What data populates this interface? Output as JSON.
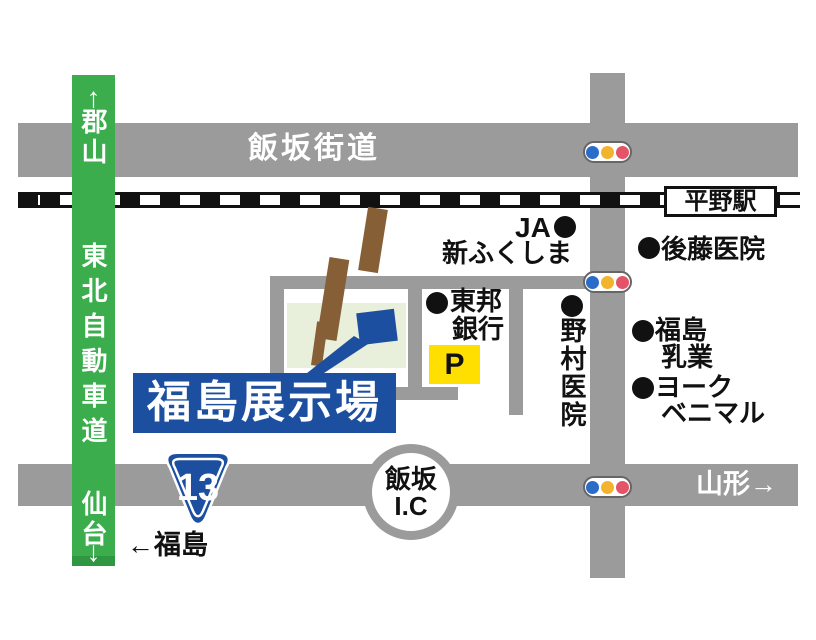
{
  "colors": {
    "road_gray": "#9b9b9b",
    "expressway_green": "#3bad4d",
    "venue_blue": "#1d4fa1",
    "parking_yellow": "#ffdf00",
    "site_light_green": "#e8efdb",
    "dirt_road_brown": "#875f37",
    "signal_blue": "#2b6cc8",
    "signal_yellow": "#f2b42c",
    "signal_red": "#e25466"
  },
  "expressway": {
    "name": "東北自動車道",
    "dest_top": "郡山",
    "dest_bottom": "仙台",
    "arrow_up": "↑",
    "arrow_down": "↓"
  },
  "roads": {
    "iizaka_kaido": "飯坂街道",
    "yamagata": "山形→",
    "fukushima": "←福島"
  },
  "route_shield": {
    "number": "13"
  },
  "interchange": {
    "line1": "飯坂",
    "line2": "I.C"
  },
  "station": {
    "name": "平野駅"
  },
  "venue": {
    "name": "福島展示場"
  },
  "parking": {
    "label": "P"
  },
  "pois": {
    "ja": {
      "line1": "JA",
      "line2": "新ふくしま"
    },
    "goto": {
      "name": "後藤医院"
    },
    "toho": {
      "line1": "東邦",
      "line2": "銀行"
    },
    "nomura": {
      "name": "野村医院"
    },
    "nyugyo": {
      "line1": "福島",
      "line2": "乳業"
    },
    "york": {
      "line1": "ヨーク",
      "line2": "ベニマル"
    }
  }
}
